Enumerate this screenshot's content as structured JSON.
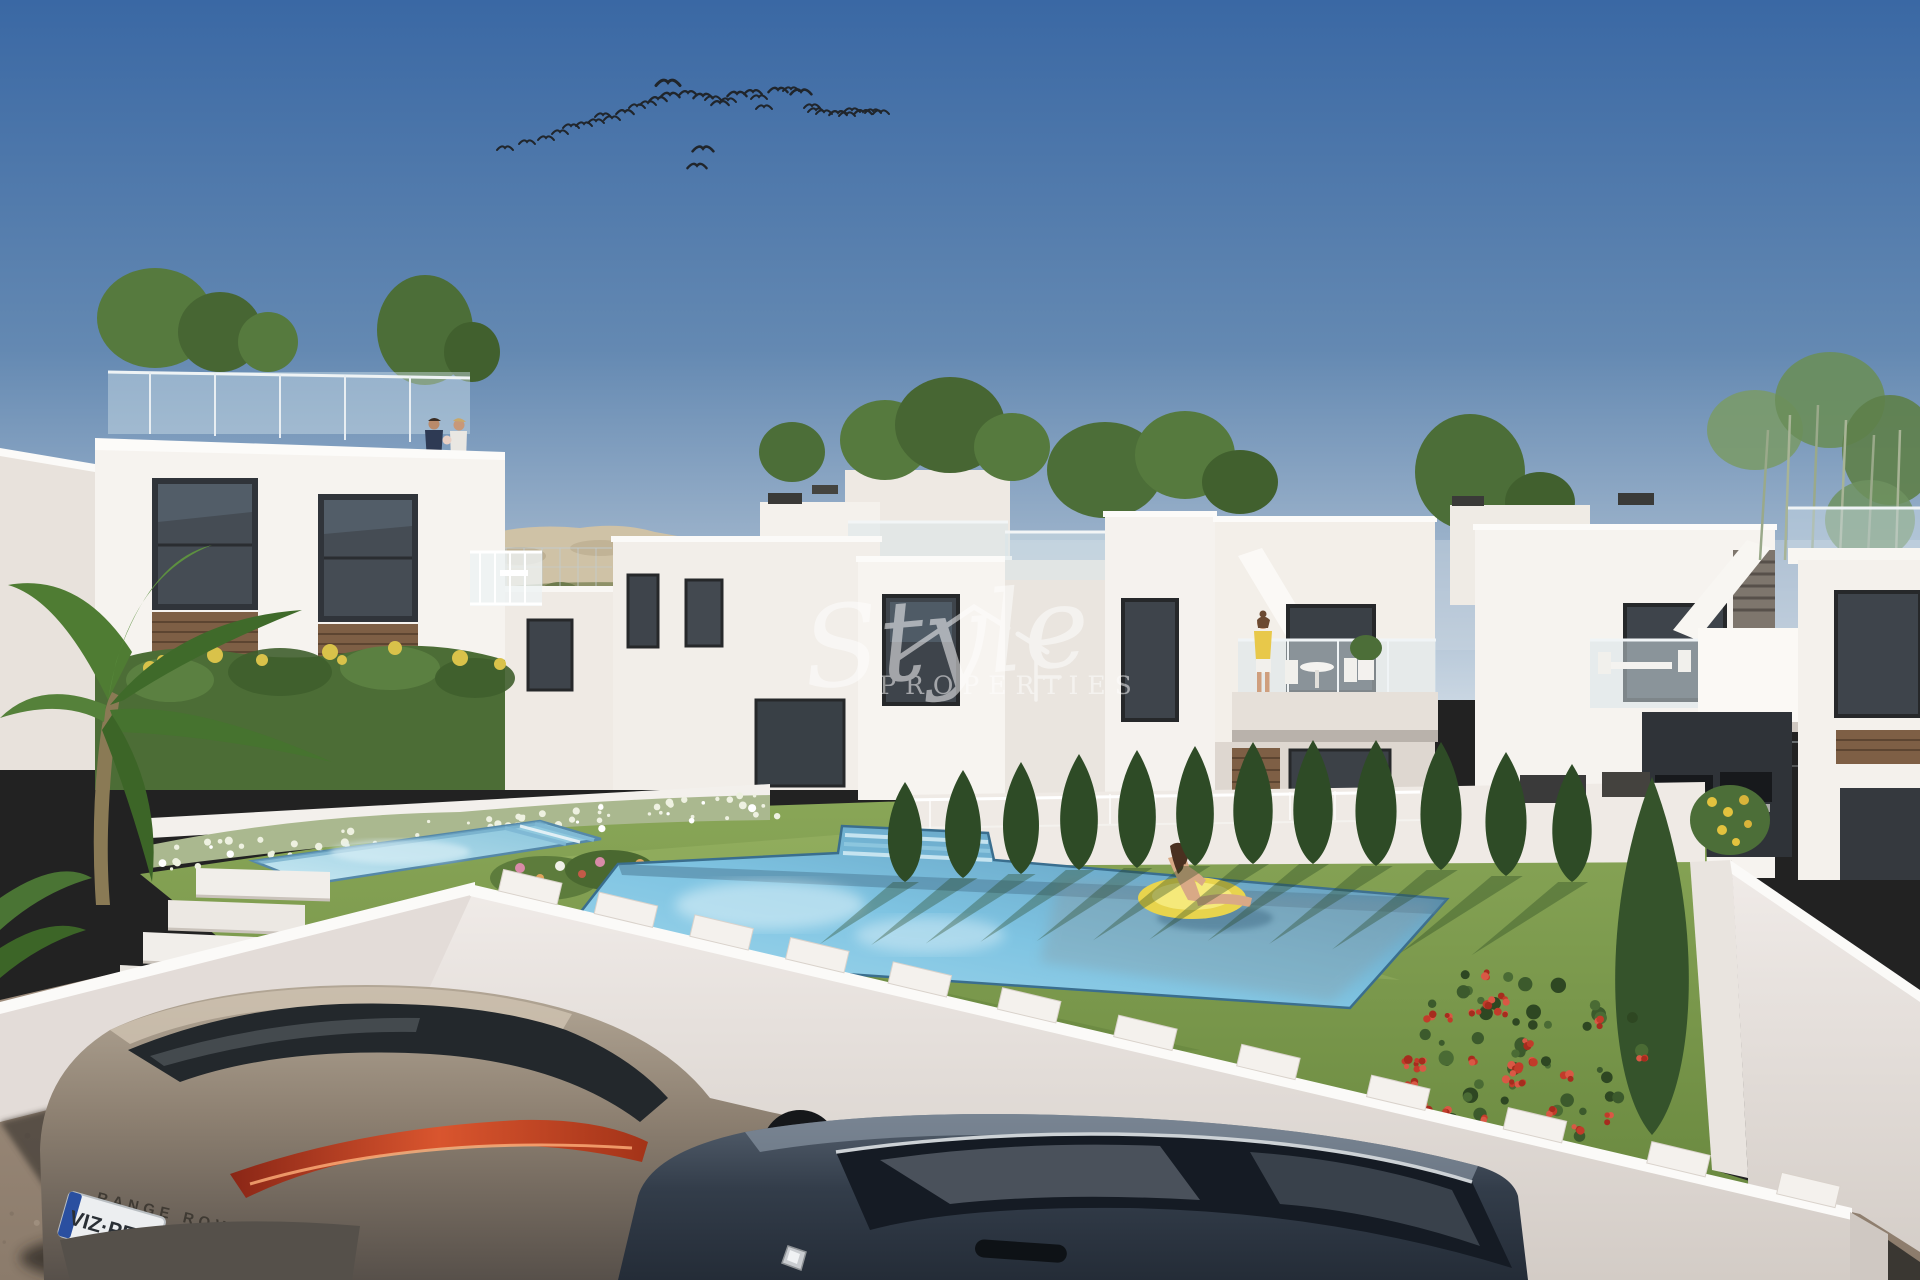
{
  "watermark": {
    "script": "Style",
    "sub": "PROPERTIES",
    "color": "#ffffff",
    "opacity": 0.52
  },
  "vehicles": {
    "suv": {
      "make_text": "RANGE ROVER",
      "plate": "VIZ·PEOP",
      "body_color": "#8d8071"
    },
    "sedan": {
      "body_color": "#333d4a"
    }
  },
  "palette": {
    "sky_top": "#3a68a4",
    "sky_horizon": "#c9d6e2",
    "building_white": "#f6f3ef",
    "pool_water": "#7fc4e2",
    "grass": "#7d9c4f",
    "cypress": "#2e4b26",
    "gravel": "#a08f7c",
    "tail_light": "#d9552e",
    "float_yellow": "#e8d44d"
  },
  "scene": {
    "description": "3D render of white modern villas with communal pools, garden, and two parked cars",
    "birds": [
      [
        505,
        149,
        1
      ],
      [
        527,
        143,
        1
      ],
      [
        546,
        139,
        1
      ],
      [
        560,
        133,
        1
      ],
      [
        571,
        127,
        1
      ],
      [
        584,
        125,
        1
      ],
      [
        596,
        122,
        1
      ],
      [
        603,
        116,
        1
      ],
      [
        612,
        119,
        1
      ],
      [
        625,
        113,
        1.1
      ],
      [
        637,
        107,
        1
      ],
      [
        648,
        104,
        1
      ],
      [
        658,
        100,
        1.1
      ],
      [
        670,
        96,
        1.2
      ],
      [
        668,
        84,
        1.5
      ],
      [
        688,
        94,
        1.1
      ],
      [
        703,
        97,
        1.2
      ],
      [
        713,
        99,
        1
      ],
      [
        720,
        104,
        1.1
      ],
      [
        728,
        101,
        1
      ],
      [
        737,
        95,
        1.2
      ],
      [
        753,
        93,
        1.1
      ],
      [
        759,
        98,
        1
      ],
      [
        764,
        108,
        1
      ],
      [
        778,
        91,
        1.2
      ],
      [
        791,
        90,
        1
      ],
      [
        801,
        93,
        1.3
      ],
      [
        812,
        107,
        1
      ],
      [
        816,
        111,
        1
      ],
      [
        824,
        113,
        1
      ],
      [
        838,
        114,
        1.1
      ],
      [
        847,
        115,
        1
      ],
      [
        852,
        111,
        1
      ],
      [
        863,
        113,
        1.1
      ],
      [
        873,
        112,
        1
      ],
      [
        881,
        113,
        1
      ],
      [
        703,
        150,
        1.3
      ],
      [
        697,
        167,
        1.2
      ]
    ],
    "cypresses": [
      [
        905,
        882,
        100,
        40
      ],
      [
        963,
        878,
        108,
        42
      ],
      [
        1021,
        874,
        112,
        42
      ],
      [
        1079,
        870,
        116,
        44
      ],
      [
        1137,
        868,
        118,
        44
      ],
      [
        1195,
        866,
        120,
        44
      ],
      [
        1253,
        864,
        122,
        46
      ],
      [
        1313,
        864,
        124,
        46
      ],
      [
        1376,
        866,
        126,
        48
      ],
      [
        1441,
        870,
        128,
        48
      ],
      [
        1506,
        876,
        124,
        48
      ],
      [
        1572,
        882,
        118,
        46
      ],
      [
        1652,
        1135,
        358,
        86
      ]
    ],
    "merlons": {
      "x1": 478,
      "y1": 886,
      "x2": 1845,
      "y2": 1210,
      "w": 60,
      "h": 22,
      "positions": [
        0.015,
        0.085,
        0.155,
        0.225,
        0.3,
        0.38,
        0.465,
        0.555,
        0.65,
        0.75,
        0.855,
        0.95
      ]
    },
    "hedge_dots": {
      "n": 85,
      "x1": 155,
      "x2": 770,
      "y1": 860,
      "y2": 802
    },
    "red_bush": {
      "cx": 1520,
      "cy": 1062,
      "rx": 128,
      "ry": 100,
      "greens": 55,
      "reds": 30
    },
    "fences": [
      {
        "x1": 470,
        "x2": 612,
        "y": 548,
        "h": 38,
        "step": 18
      },
      {
        "x1": 1695,
        "x2": 1918,
        "y": 742,
        "h": 48,
        "step": 22
      }
    ],
    "speckles": {
      "n": 45,
      "x": 0,
      "w": 430,
      "y": 1110,
      "h": 170
    },
    "people": [
      {
        "id": "rooftop-couple",
        "desc": "couple standing on left roof terrace"
      },
      {
        "id": "balcony-woman",
        "desc": "woman with child on central balcony"
      },
      {
        "id": "pool-swimmer",
        "desc": "woman on yellow float in main pool"
      }
    ]
  }
}
